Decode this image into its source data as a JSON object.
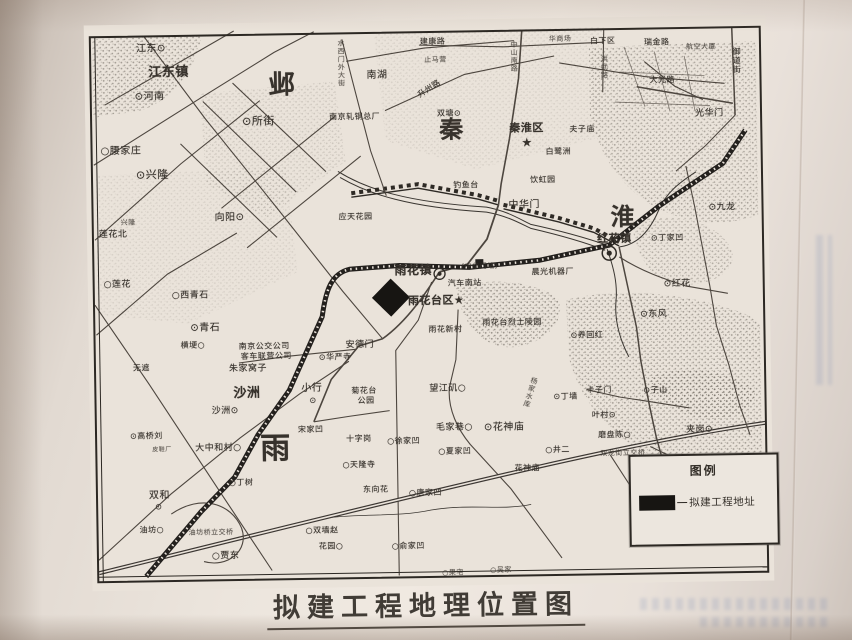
{
  "photo": {
    "background": "#ece5dd",
    "shadow": "#b3a79d"
  },
  "caption": {
    "title": "拟建工程地理位置图"
  },
  "legend": {
    "title": "图例",
    "swatch_color": "#171512",
    "items": [
      {
        "label": "拟建工程地址"
      }
    ]
  },
  "map": {
    "ink": "#37322c",
    "marker": {
      "meaning": "拟建工程地址",
      "color": "#171512"
    },
    "labels": [
      {
        "t": "江东⊙",
        "x": 52,
        "y": 20,
        "s": 10
      },
      {
        "t": "江东镇",
        "x": 64,
        "y": 42,
        "s": 13,
        "b": 1
      },
      {
        "t": "⊙河南",
        "x": 50,
        "y": 68,
        "s": 10
      },
      {
        "t": "⊙所街",
        "x": 157,
        "y": 93,
        "s": 11
      },
      {
        "t": "○腰家庄",
        "x": 15,
        "y": 122,
        "s": 10
      },
      {
        "t": "⊙兴隆",
        "x": 50,
        "y": 145,
        "s": 11
      },
      {
        "t": "邺",
        "x": 184,
        "y": 50,
        "s": 26,
        "b": 1
      },
      {
        "t": "南湖",
        "x": 282,
        "y": 50,
        "s": 10
      },
      {
        "t": "水西门外大街",
        "x": 253,
        "y": 18,
        "s": 7,
        "v": 1
      },
      {
        "t": "南京轧钢总厂",
        "x": 244,
        "y": 92,
        "s": 8
      },
      {
        "t": "止马营",
        "x": 340,
        "y": 37,
        "s": 7
      },
      {
        "t": "建康路",
        "x": 336,
        "y": 18,
        "s": 8
      },
      {
        "t": "华商场",
        "x": 465,
        "y": 18,
        "s": 7
      },
      {
        "t": "白下区",
        "x": 506,
        "y": 20,
        "s": 8
      },
      {
        "t": "洪武路",
        "x": 516,
        "y": 38,
        "s": 7,
        "v": 1
      },
      {
        "t": "中山南路",
        "x": 426,
        "y": 22,
        "s": 7,
        "v": 1
      },
      {
        "t": "升州路",
        "x": 332,
        "y": 65,
        "s": 8,
        "r": -32
      },
      {
        "t": "双塘⊙",
        "x": 352,
        "y": 90,
        "s": 8
      },
      {
        "t": "秦",
        "x": 354,
        "y": 98,
        "s": 24,
        "b": 1
      },
      {
        "t": "秦淮区",
        "x": 424,
        "y": 104,
        "s": 11,
        "b": 1
      },
      {
        "t": "★",
        "x": 436,
        "y": 118,
        "s": 12
      },
      {
        "t": "夫子庙",
        "x": 484,
        "y": 108,
        "s": 8
      },
      {
        "t": "白鹭洲",
        "x": 460,
        "y": 130,
        "s": 8
      },
      {
        "t": "饮虹园",
        "x": 444,
        "y": 158,
        "s": 8
      },
      {
        "t": "瑞金路",
        "x": 560,
        "y": 22,
        "s": 8
      },
      {
        "t": "航空大厦",
        "x": 602,
        "y": 28,
        "s": 7
      },
      {
        "t": "大光路",
        "x": 565,
        "y": 60,
        "s": 8
      },
      {
        "t": "光华门",
        "x": 610,
        "y": 94,
        "s": 9
      },
      {
        "t": "御道街",
        "x": 648,
        "y": 32,
        "s": 8,
        "v": 1
      },
      {
        "t": "钓鱼台",
        "x": 367,
        "y": 162,
        "s": 8
      },
      {
        "t": "应天花园",
        "x": 252,
        "y": 192,
        "s": 8
      },
      {
        "t": "中华门",
        "x": 422,
        "y": 182,
        "s": 10
      },
      {
        "t": "(中华门站)",
        "x": 374,
        "y": 244,
        "s": 7
      },
      {
        "t": "雨花镇",
        "x": 307,
        "y": 244,
        "s": 12,
        "b": 1
      },
      {
        "t": "汽车南站",
        "x": 360,
        "y": 260,
        "s": 8
      },
      {
        "t": "雨花台区★",
        "x": 320,
        "y": 275,
        "s": 11,
        "b": 1
      },
      {
        "t": "雨花新村",
        "x": 340,
        "y": 306,
        "s": 8
      },
      {
        "t": "安德门",
        "x": 257,
        "y": 320,
        "s": 9
      },
      {
        "t": "⊙华严寺",
        "x": 230,
        "y": 332,
        "s": 8
      },
      {
        "t": "菊花台",
        "x": 262,
        "y": 366,
        "s": 8
      },
      {
        "t": "公园",
        "x": 268,
        "y": 376,
        "s": 8
      },
      {
        "t": "雨花台烈士陵园",
        "x": 394,
        "y": 300,
        "s": 8
      },
      {
        "t": "晨光机器厂",
        "x": 444,
        "y": 250,
        "s": 8
      },
      {
        "t": "⊙养回红",
        "x": 482,
        "y": 314,
        "s": 8
      },
      {
        "t": "红花镇",
        "x": 510,
        "y": 216,
        "s": 11,
        "b": 1
      },
      {
        "t": "淮",
        "x": 524,
        "y": 188,
        "s": 24,
        "b": 1
      },
      {
        "t": "⊙丁家凹",
        "x": 564,
        "y": 218,
        "s": 8
      },
      {
        "t": "⊙九龙",
        "x": 622,
        "y": 188,
        "s": 9
      },
      {
        "t": "⊙红花",
        "x": 576,
        "y": 264,
        "s": 9
      },
      {
        "t": "⊙东风",
        "x": 552,
        "y": 294,
        "s": 9
      },
      {
        "t": "⊙子山",
        "x": 554,
        "y": 370,
        "s": 8
      },
      {
        "t": "卡子门",
        "x": 497,
        "y": 369,
        "s": 8
      },
      {
        "t": "⊙丁墙",
        "x": 464,
        "y": 375,
        "s": 8
      },
      {
        "t": "叶村⊙",
        "x": 502,
        "y": 394,
        "s": 8
      },
      {
        "t": "磨盘陈○",
        "x": 508,
        "y": 414,
        "s": 8
      },
      {
        "t": "双龙街立交桥",
        "x": 510,
        "y": 433,
        "s": 7
      },
      {
        "t": "夹岗⊙",
        "x": 596,
        "y": 410,
        "s": 9
      },
      {
        "t": "望江矶○",
        "x": 340,
        "y": 365,
        "s": 9
      },
      {
        "t": "毛家巷○",
        "x": 346,
        "y": 404,
        "s": 9
      },
      {
        "t": "⊙花神庙",
        "x": 394,
        "y": 404,
        "s": 10
      },
      {
        "t": "杨家水库",
        "x": 437,
        "y": 358,
        "s": 7,
        "v": 1,
        "r": 18
      },
      {
        "t": "花神庙",
        "x": 424,
        "y": 446,
        "s": 8
      },
      {
        "t": "○井二",
        "x": 455,
        "y": 428,
        "s": 8
      },
      {
        "t": "○徐家凹",
        "x": 297,
        "y": 417,
        "s": 8
      },
      {
        "t": "○夏家凹",
        "x": 348,
        "y": 428,
        "s": 8
      },
      {
        "t": "十字岗",
        "x": 256,
        "y": 414,
        "s": 8
      },
      {
        "t": "○天隆寺",
        "x": 252,
        "y": 440,
        "s": 8
      },
      {
        "t": "东向花",
        "x": 272,
        "y": 465,
        "s": 8
      },
      {
        "t": "○唐家凹",
        "x": 318,
        "y": 469,
        "s": 8
      },
      {
        "t": "○俞家凹",
        "x": 300,
        "y": 522,
        "s": 8
      },
      {
        "t": "○双墙赵",
        "x": 214,
        "y": 505,
        "s": 8
      },
      {
        "t": "花园○",
        "x": 227,
        "y": 521,
        "s": 8
      },
      {
        "t": "○贾东",
        "x": 120,
        "y": 529,
        "s": 9
      },
      {
        "t": "油坊○",
        "x": 48,
        "y": 502,
        "s": 8
      },
      {
        "t": "油坊桥立交桥",
        "x": 97,
        "y": 506,
        "s": 7
      },
      {
        "t": "双和",
        "x": 58,
        "y": 467,
        "s": 10
      },
      {
        "t": "⊙",
        "x": 64,
        "y": 479,
        "s": 8
      },
      {
        "t": "○丁树",
        "x": 138,
        "y": 456,
        "s": 8
      },
      {
        "t": "皮鞋厂",
        "x": 62,
        "y": 423,
        "s": 6
      },
      {
        "t": "大中和村○",
        "x": 105,
        "y": 421,
        "s": 9
      },
      {
        "t": "⊙高桥刘",
        "x": 40,
        "y": 408,
        "s": 8
      },
      {
        "t": "雨",
        "x": 170,
        "y": 412,
        "s": 30,
        "b": 1
      },
      {
        "t": "宋家凹",
        "x": 208,
        "y": 404,
        "s": 8
      },
      {
        "t": "沙洲",
        "x": 144,
        "y": 364,
        "s": 13,
        "b": 1
      },
      {
        "t": "沙洲⊙",
        "x": 122,
        "y": 384,
        "s": 9
      },
      {
        "t": "小行",
        "x": 212,
        "y": 362,
        "s": 10
      },
      {
        "t": "⊙",
        "x": 220,
        "y": 375,
        "s": 8
      },
      {
        "t": "朱家窝子",
        "x": 140,
        "y": 342,
        "s": 9
      },
      {
        "t": "南京公交公司",
        "x": 150,
        "y": 320,
        "s": 8
      },
      {
        "t": "客车联营公司",
        "x": 152,
        "y": 330,
        "s": 8
      },
      {
        "t": "横埂○",
        "x": 92,
        "y": 318,
        "s": 8
      },
      {
        "t": "无遮",
        "x": 44,
        "y": 340,
        "s": 8
      },
      {
        "t": "○西青石",
        "x": 84,
        "y": 268,
        "s": 9
      },
      {
        "t": "⊙青石",
        "x": 102,
        "y": 300,
        "s": 10
      },
      {
        "t": "莲花北",
        "x": 12,
        "y": 206,
        "s": 9
      },
      {
        "t": "○莲花",
        "x": 16,
        "y": 256,
        "s": 9
      },
      {
        "t": "兴隆",
        "x": 34,
        "y": 195,
        "s": 7
      },
      {
        "t": "向阳⊙",
        "x": 128,
        "y": 190,
        "s": 10
      },
      {
        "t": "○吴家",
        "x": 398,
        "y": 548,
        "s": 7
      },
      {
        "t": "○果宅",
        "x": 350,
        "y": 550,
        "s": 7
      }
    ]
  }
}
